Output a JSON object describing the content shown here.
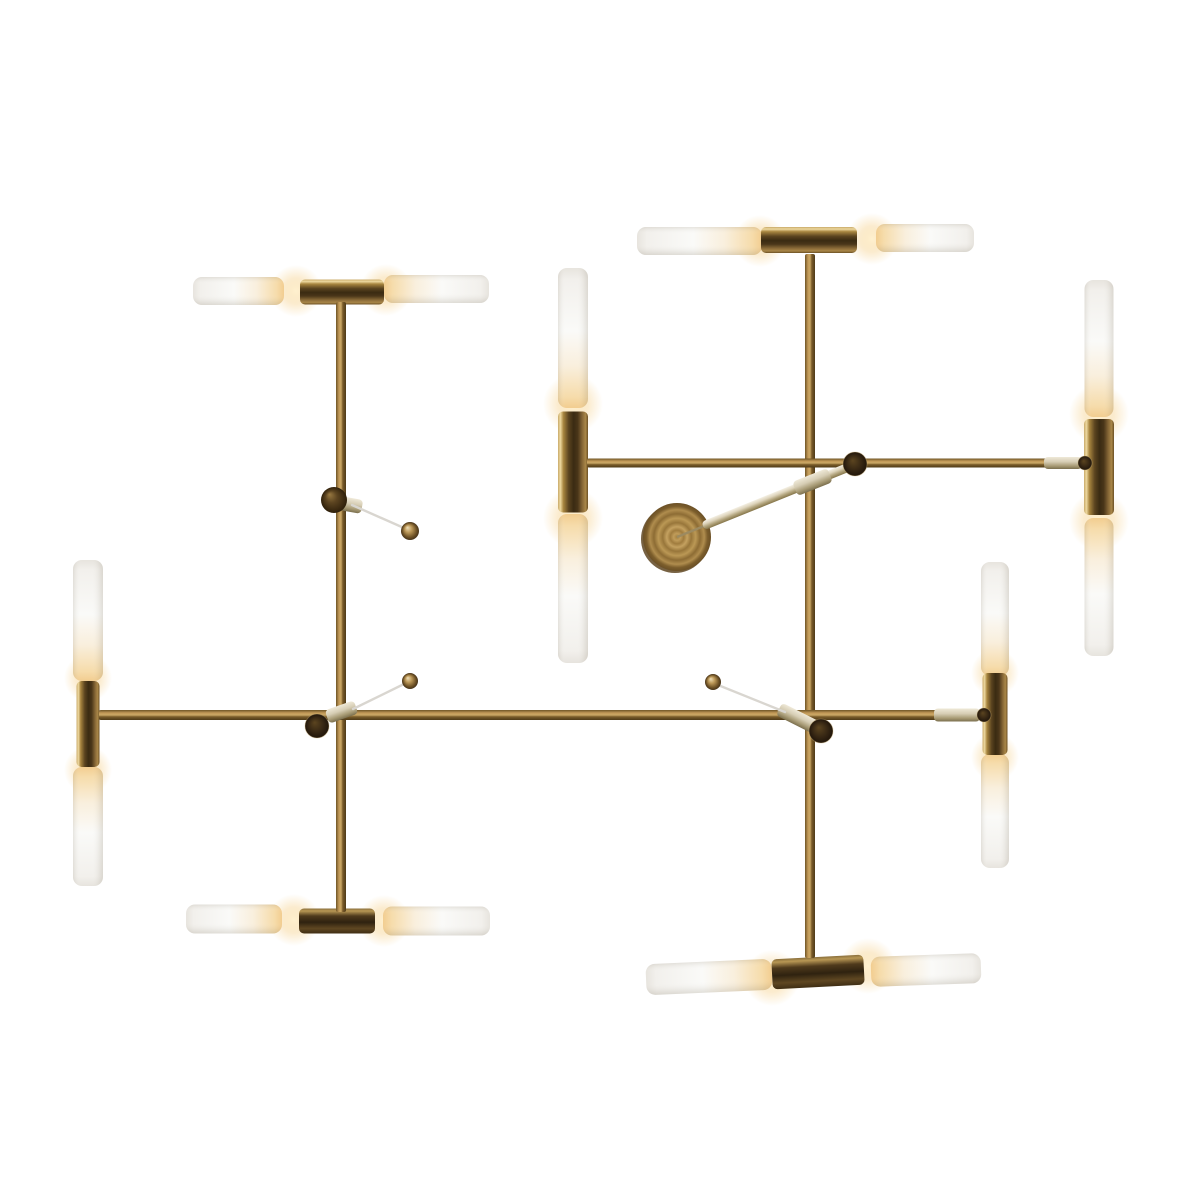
{
  "scene": {
    "alt": "Modern brass chandelier with sixteen tubular frosted glass shades, warm lit ends, mounted on intersecting horizontal and vertical brass rods with a round spun-brass ceiling canopy and thin support wires"
  },
  "palette": {
    "background": "#ffffff",
    "wire": "#d9d6d0",
    "needle": "#9c8a60",
    "cap_rim": "rgba(210,180,120,0.35)",
    "canopy_rim": "#5f4722",
    "gradients": {
      "rod": [
        [
          0,
          "#6e5426"
        ],
        [
          0.3,
          "#c39a58"
        ],
        [
          0.5,
          "#caa866"
        ],
        [
          0.68,
          "#7a5c2a"
        ],
        [
          1,
          "#4e3a18"
        ]
      ],
      "socket": [
        [
          0,
          "#c8a968"
        ],
        [
          0.08,
          "#eed9a0"
        ],
        [
          0.18,
          "#a8853f"
        ],
        [
          0.36,
          "#5a431f"
        ],
        [
          0.52,
          "#3a2b12"
        ],
        [
          0.66,
          "#4a3619"
        ],
        [
          0.82,
          "#8a6a38"
        ],
        [
          0.92,
          "#a98748"
        ],
        [
          1,
          "#6b4f24"
        ]
      ],
      "socket_dark": [
        [
          0,
          "#8a6f3c"
        ],
        [
          0.1,
          "#b89754"
        ],
        [
          0.3,
          "#4f3a1c"
        ],
        [
          0.55,
          "#2f2210"
        ],
        [
          0.8,
          "#5f4722"
        ],
        [
          1,
          "#3f2e14"
        ]
      ],
      "tube_lit": [
        [
          0,
          "#f2cd90"
        ],
        [
          0.08,
          "#f6dcab"
        ],
        [
          0.3,
          "#f9efdd"
        ],
        [
          0.55,
          "#fafaf8"
        ],
        [
          0.92,
          "#f2f0ec"
        ],
        [
          1,
          "#e7e4de"
        ]
      ],
      "tube_shade": [
        [
          0,
          "rgba(125,115,95,0.16)"
        ],
        [
          0.25,
          "rgba(255,255,255,0)"
        ],
        [
          0.62,
          "rgba(255,255,255,0)"
        ],
        [
          0.85,
          "rgba(125,115,95,0.08)"
        ],
        [
          1,
          "rgba(125,115,95,0.2)"
        ]
      ],
      "sleeve": [
        [
          0,
          "#efe9d8"
        ],
        [
          0.4,
          "#d6cdb4"
        ],
        [
          0.75,
          "#a79a74"
        ],
        [
          1,
          "#7b6f4e"
        ]
      ],
      "stem": [
        [
          0,
          "#f4f0e4"
        ],
        [
          0.35,
          "#ddd3ba"
        ],
        [
          0.65,
          "#b3a57e"
        ],
        [
          1,
          "#857549"
        ]
      ],
      "glow": [
        [
          0,
          "rgba(255,240,205,0.95)"
        ],
        [
          0.5,
          "rgba(247,216,158,0.5)"
        ],
        [
          1,
          "rgba(247,216,158,0)"
        ]
      ],
      "ball": [
        [
          0,
          "#f0e0ba"
        ],
        [
          0.4,
          "#bc9858"
        ],
        [
          0.8,
          "#6b4f24"
        ],
        [
          1,
          "#46331a"
        ]
      ],
      "ball_dark": [
        [
          0,
          "#9a7a42"
        ],
        [
          0.45,
          "#5c4420"
        ],
        [
          1,
          "#2e1f0a"
        ]
      ],
      "cap": [
        [
          0,
          "#5c4520"
        ],
        [
          0.6,
          "#382814"
        ],
        [
          1,
          "#20150a"
        ]
      ],
      "canopy": [
        [
          0,
          "#a5823f"
        ],
        [
          0.1,
          "#c09c5a"
        ],
        [
          0.2,
          "#a07c3e"
        ],
        [
          0.3,
          "#c4a160"
        ],
        [
          0.42,
          "#98763a"
        ],
        [
          0.55,
          "#bb9855"
        ],
        [
          0.68,
          "#8d6c34"
        ],
        [
          0.8,
          "#b08d4e"
        ],
        [
          0.9,
          "#7c5e2c"
        ],
        [
          1,
          "#6b5026"
        ]
      ]
    }
  },
  "parts": {
    "glow_spots": [
      {
        "cx": 296,
        "cy": 291,
        "r": 26
      },
      {
        "cx": 386,
        "cy": 290,
        "r": 26
      },
      {
        "cx": 760,
        "cy": 241,
        "r": 26
      },
      {
        "cx": 872,
        "cy": 239,
        "r": 26
      },
      {
        "cx": 294,
        "cy": 920,
        "r": 26
      },
      {
        "cx": 384,
        "cy": 921,
        "r": 26
      },
      {
        "cx": 772,
        "cy": 978,
        "r": 28
      },
      {
        "cx": 868,
        "cy": 966,
        "r": 28
      },
      {
        "cx": 88,
        "cy": 678,
        "r": 24
      },
      {
        "cx": 88,
        "cy": 770,
        "r": 24
      },
      {
        "cx": 995,
        "cy": 673,
        "r": 24
      },
      {
        "cx": 995,
        "cy": 757,
        "r": 24
      },
      {
        "cx": 573,
        "cy": 404,
        "r": 30
      },
      {
        "cx": 573,
        "cy": 518,
        "r": 30
      },
      {
        "cx": 1099,
        "cy": 414,
        "r": 30
      },
      {
        "cx": 1099,
        "cy": 521,
        "r": 30
      }
    ],
    "tubes": [
      {
        "name": "tube-top-left-outer",
        "o": "h",
        "x1": 193,
        "x2": 284,
        "c": 291,
        "d": 28,
        "lit": "right"
      },
      {
        "name": "tube-top-left-inner",
        "o": "h",
        "x1": 384,
        "x2": 489,
        "c": 289,
        "d": 28,
        "lit": "left"
      },
      {
        "name": "tube-top-right-inner",
        "o": "h",
        "x1": 637,
        "x2": 762,
        "c": 241,
        "d": 28,
        "lit": "right"
      },
      {
        "name": "tube-top-right-outer",
        "o": "h",
        "x1": 876,
        "x2": 974,
        "c": 238,
        "d": 28,
        "lit": "left"
      },
      {
        "name": "tube-bottom-left-outer",
        "o": "h",
        "x1": 186,
        "x2": 282,
        "c": 919,
        "d": 29,
        "lit": "right"
      },
      {
        "name": "tube-bottom-left-inner",
        "o": "h",
        "x1": 383,
        "x2": 490,
        "c": 921,
        "d": 29,
        "lit": "left"
      },
      {
        "name": "tube-bottom-right-inner",
        "o": "h",
        "x1": 646,
        "x2": 772,
        "c": 977,
        "d": 31,
        "lit": "right",
        "rot": -2.5
      },
      {
        "name": "tube-bottom-right-outer",
        "o": "h",
        "x1": 871,
        "x2": 981,
        "c": 970,
        "d": 30,
        "lit": "left",
        "rot": -2
      },
      {
        "name": "tube-main-left-upper",
        "o": "v",
        "y1": 560,
        "y2": 681,
        "c": 88,
        "d": 30,
        "lit": "bottom"
      },
      {
        "name": "tube-main-left-lower",
        "o": "v",
        "y1": 767,
        "y2": 886,
        "c": 88,
        "d": 30,
        "lit": "top"
      },
      {
        "name": "tube-main-right-upper",
        "o": "v",
        "y1": 562,
        "y2": 676,
        "c": 995,
        "d": 28,
        "lit": "bottom"
      },
      {
        "name": "tube-main-right-lower",
        "o": "v",
        "y1": 754,
        "y2": 868,
        "c": 995,
        "d": 28,
        "lit": "top"
      },
      {
        "name": "tube-mid-left-upper",
        "o": "v",
        "y1": 268,
        "y2": 408,
        "c": 573,
        "d": 30,
        "lit": "bottom"
      },
      {
        "name": "tube-mid-left-lower",
        "o": "v",
        "y1": 514,
        "y2": 663,
        "c": 573,
        "d": 30,
        "lit": "top"
      },
      {
        "name": "tube-mid-right-upper",
        "o": "v",
        "y1": 280,
        "y2": 417,
        "c": 1099,
        "d": 29,
        "lit": "bottom"
      },
      {
        "name": "tube-mid-right-lower",
        "o": "v",
        "y1": 518,
        "y2": 656,
        "c": 1099,
        "d": 29,
        "lit": "top"
      }
    ],
    "sockets": [
      {
        "name": "socket-top-left",
        "cx": 342,
        "cy": 292,
        "w": 84,
        "h": 25,
        "o": "h",
        "tone": "socket"
      },
      {
        "name": "socket-top-right",
        "cx": 809,
        "cy": 240,
        "w": 96,
        "h": 26,
        "o": "h",
        "tone": "socket"
      },
      {
        "name": "socket-bottom-left",
        "cx": 337,
        "cy": 921,
        "w": 76,
        "h": 25,
        "o": "h",
        "tone": "dark"
      },
      {
        "name": "socket-bottom-right",
        "cx": 818,
        "cy": 972,
        "w": 92,
        "h": 30,
        "o": "h",
        "tone": "dark",
        "rot": -3
      },
      {
        "name": "socket-main-left",
        "cx": 88,
        "cy": 724,
        "w": 23,
        "h": 86,
        "o": "v",
        "tone": "socket"
      },
      {
        "name": "socket-main-right",
        "cx": 995,
        "cy": 714,
        "w": 25,
        "h": 82,
        "o": "v",
        "tone": "socket"
      },
      {
        "name": "socket-mid-left",
        "cx": 573,
        "cy": 462,
        "w": 30,
        "h": 101,
        "o": "v",
        "tone": "socket"
      },
      {
        "name": "socket-mid-right",
        "cx": 1099,
        "cy": 467,
        "w": 30,
        "h": 96,
        "o": "v",
        "tone": "socket"
      }
    ],
    "rods": [
      {
        "name": "left-vertical-rod",
        "o": "v",
        "c": 341,
        "a1": 302,
        "a2": 912,
        "w": 10
      },
      {
        "name": "right-vertical-rod",
        "o": "v",
        "c": 810,
        "a1": 254,
        "a2": 958,
        "w": 10
      },
      {
        "name": "main-horizontal-bar",
        "o": "h",
        "c": 715,
        "a1": 99,
        "a2": 986,
        "w": 10
      },
      {
        "name": "upper-horizontal-bar",
        "o": "h",
        "c": 463,
        "a1": 587,
        "a2": 1084,
        "w": 9
      }
    ],
    "canopy": {
      "name": "ceiling-canopy-disc",
      "cx": 677,
      "cy": 537,
      "r": 34
    },
    "stem": {
      "name": "canopy-stem-rod",
      "x1": 703,
      "y1": 526,
      "x2": 849,
      "y2": 467,
      "w": 9,
      "needle": {
        "x1": 677,
        "y1": 537,
        "x2": 714,
        "y2": 522
      }
    },
    "sleeves": [
      {
        "name": "connector-sleeve-left",
        "x1": 327,
        "y1": 717,
        "x2": 356,
        "y2": 707,
        "w": 14
      },
      {
        "name": "connector-sleeve-right",
        "x1": 779,
        "y1": 709,
        "x2": 817,
        "y2": 728,
        "w": 14
      },
      {
        "name": "connector-sleeve-stem",
        "x1": 795,
        "y1": 489,
        "x2": 830,
        "y2": 475,
        "w": 15
      },
      {
        "name": "pivot-sleeve-upper",
        "x1": 340,
        "y1": 503,
        "x2": 362,
        "y2": 507,
        "w": 14
      },
      {
        "name": "bar-end-sleeve-main-right",
        "x1": 934,
        "y1": 715,
        "x2": 980,
        "y2": 715,
        "w": 13
      },
      {
        "name": "bar-end-sleeve-upper-right",
        "x1": 1044,
        "y1": 463,
        "x2": 1082,
        "y2": 463,
        "w": 12
      }
    ],
    "caps": [
      {
        "name": "end-cap-left-junction",
        "cx": 317,
        "cy": 726,
        "r": 12
      },
      {
        "name": "end-cap-right-junction",
        "cx": 821,
        "cy": 731,
        "r": 12
      },
      {
        "name": "end-cap-stem-knob",
        "cx": 855,
        "cy": 464,
        "r": 12
      },
      {
        "name": "end-cap-upper-bar-right",
        "cx": 1085,
        "cy": 463,
        "r": 7
      },
      {
        "name": "end-cap-main-bar-right",
        "cx": 984,
        "cy": 715,
        "r": 7
      }
    ],
    "wires": [
      {
        "name": "support-wire-upper",
        "x1": 352,
        "y1": 505,
        "x2": 404,
        "y2": 528
      },
      {
        "name": "support-wire-left",
        "x1": 353,
        "y1": 709,
        "x2": 404,
        "y2": 684
      },
      {
        "name": "support-wire-right",
        "x1": 785,
        "y1": 712,
        "x2": 718,
        "y2": 685
      }
    ],
    "balls": [
      {
        "name": "pivot-ball-left-rod",
        "cx": 334,
        "cy": 500,
        "r": 13,
        "tone": "dark"
      },
      {
        "name": "wire-ball-upper",
        "cx": 410,
        "cy": 531,
        "r": 9,
        "tone": "brass"
      },
      {
        "name": "wire-ball-left",
        "cx": 410,
        "cy": 681,
        "r": 8,
        "tone": "brass"
      },
      {
        "name": "wire-ball-right",
        "cx": 713,
        "cy": 682,
        "r": 8,
        "tone": "brass"
      }
    ]
  }
}
